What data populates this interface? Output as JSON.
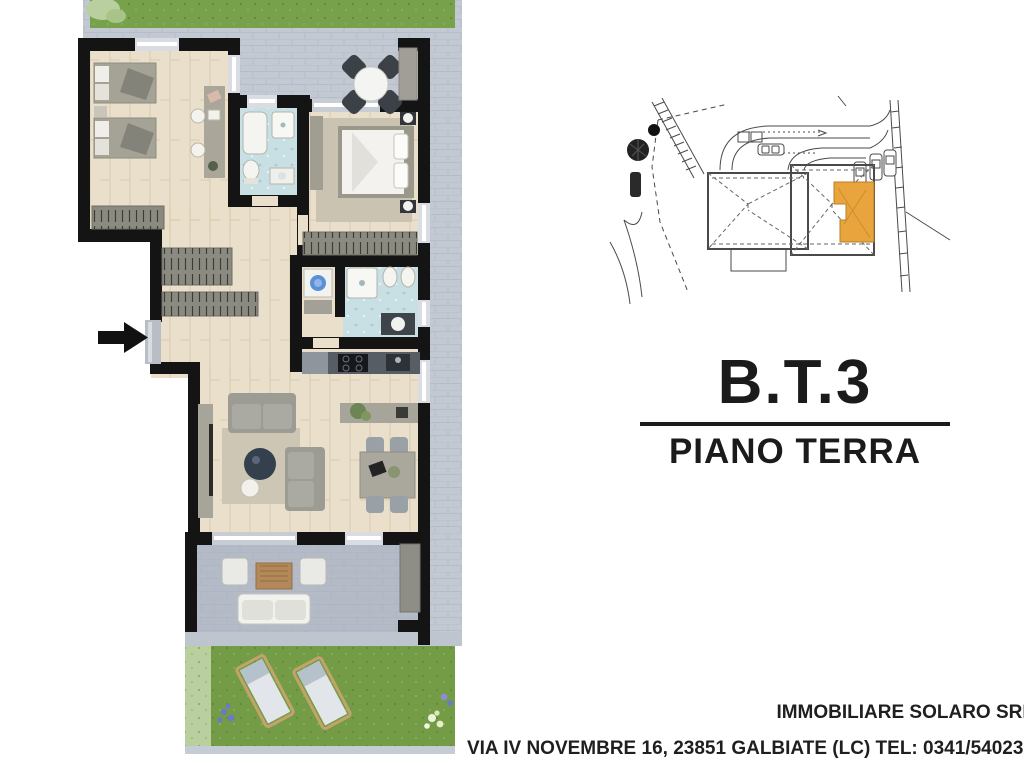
{
  "title": {
    "unit": "B.T.3",
    "floor": "PIANO TERRA"
  },
  "footer": {
    "agency": "IMMOBILIARE SOLARO SRL",
    "address": "VIA IV NOVEMBRE 16, 23851 GALBIATE (LC) TEL: 0341/540237"
  },
  "colors": {
    "wall": "#141414",
    "wood_floor": "#eadfcb",
    "paving": "#c3c9d2",
    "paving_dark": "#b4bbc7",
    "grass": "#78a14b",
    "hedge": "#b9cfa0",
    "bath_tile": "#c8e0e3",
    "wardrobe": "#8b8a80",
    "sofa": "#9c9c94",
    "kitchen_counter": "#474d54",
    "highlight_unit": "#e9a43e"
  },
  "plan_legend": {
    "rooms": [
      "bedroom",
      "bathroom-1",
      "master-bedroom",
      "hallway",
      "laundry-closet",
      "bathroom-2",
      "kitchen",
      "living-room",
      "upper-patio",
      "lower-patio",
      "garden"
    ],
    "entrance_marker": "arrow-right"
  }
}
